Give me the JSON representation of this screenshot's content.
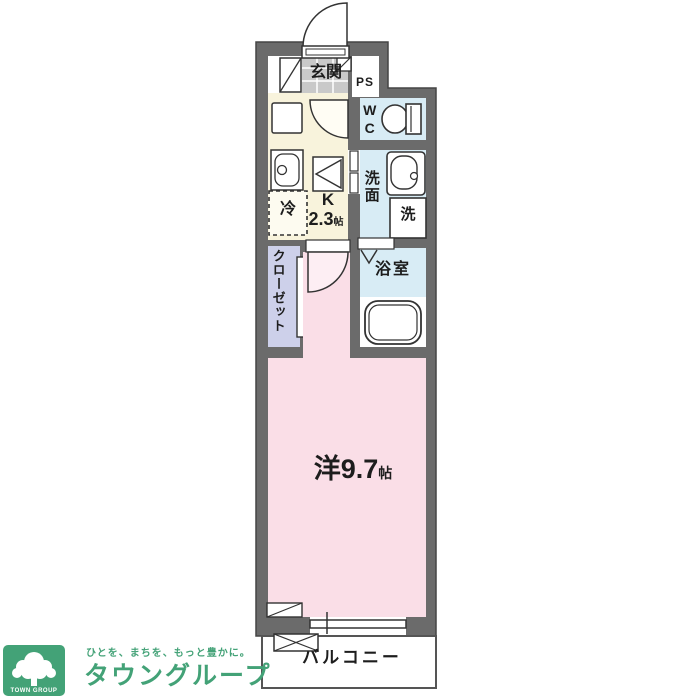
{
  "plan": {
    "rooms": {
      "entrance": "玄関",
      "pipe_space": "PS",
      "toilet": "WC",
      "washroom": "洗面",
      "washing_machine": "洗",
      "bathroom": "浴室",
      "kitchen_mark": "K",
      "kitchen_size": "2.3",
      "kitchen_size_unit": "帖",
      "refrigerator": "冷",
      "closet": "クローゼット",
      "main_room": "洋9.7",
      "main_room_unit": "帖",
      "balcony": "バルコニー"
    },
    "colors": {
      "wall": "#6b6b6b",
      "kitchen": "#f8f3dc",
      "wet_area": "#d8ecf5",
      "room_pink": "#fadee7",
      "closet_lavender": "#cdd0ea",
      "entrance_tile": "#c9c9c9",
      "brand_green": "#43a277"
    }
  },
  "branding": {
    "logo_text": "TOWN GROUP",
    "tagline": "ひとを、まちを、もっと豊かに。",
    "brand_name": "タウングループ"
  }
}
